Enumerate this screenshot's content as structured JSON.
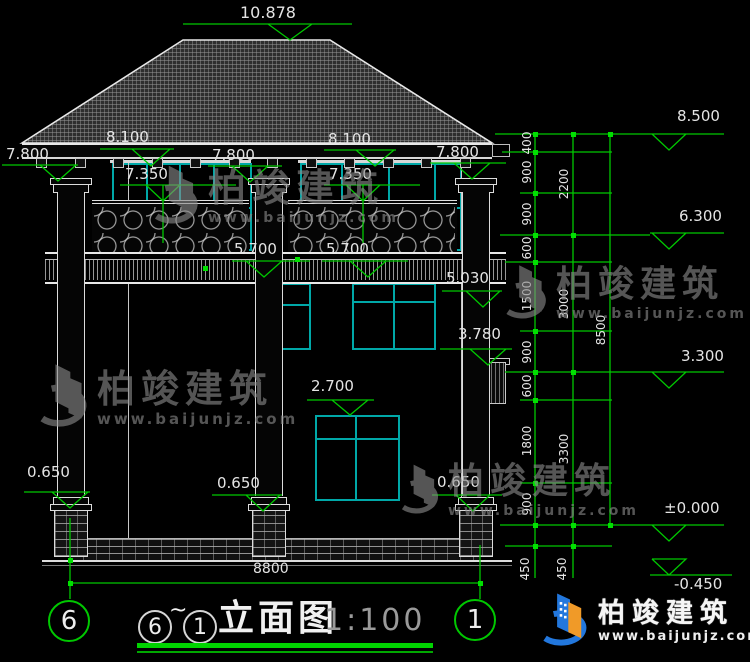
{
  "drawing": {
    "title": {
      "axis_start": "6",
      "tilde": "~",
      "axis_end": "1",
      "name": "立面图",
      "scale": "1:100"
    },
    "axis_bubbles": {
      "left": "6",
      "right": "1"
    },
    "overall_dim": "8800",
    "labels": [
      {
        "id": "ridge",
        "text": "10.878"
      },
      {
        "id": "l8100a",
        "text": "8.100"
      },
      {
        "id": "l8100b",
        "text": "8.100"
      },
      {
        "id": "l7800a",
        "text": "7.800"
      },
      {
        "id": "l7800b",
        "text": "7.800"
      },
      {
        "id": "l7800c",
        "text": "7.800"
      },
      {
        "id": "l7350a",
        "text": "7.350"
      },
      {
        "id": "l7350b",
        "text": "7.350"
      },
      {
        "id": "l5700a",
        "text": "5.700"
      },
      {
        "id": "l5700b",
        "text": "5.700"
      },
      {
        "id": "l5030",
        "text": "5.030"
      },
      {
        "id": "l3780",
        "text": "3.780"
      },
      {
        "id": "l2700",
        "text": "2.700"
      },
      {
        "id": "l0650a",
        "text": "0.650"
      },
      {
        "id": "l0650b",
        "text": "0.650"
      },
      {
        "id": "l0650c",
        "text": "0.650"
      },
      {
        "id": "r8500",
        "text": "8.500"
      },
      {
        "id": "r6300",
        "text": "6.300"
      },
      {
        "id": "r3300",
        "text": "3.300"
      },
      {
        "id": "r0000",
        "text": "±0.000"
      },
      {
        "id": "rn450",
        "text": "-0.450"
      },
      {
        "id": "d8800",
        "text": "8800"
      },
      {
        "id": "c400",
        "text": "400"
      },
      {
        "id": "c900a",
        "text": "900"
      },
      {
        "id": "c900b",
        "text": "900"
      },
      {
        "id": "c600a",
        "text": "600"
      },
      {
        "id": "c1500",
        "text": "1500"
      },
      {
        "id": "c900c",
        "text": "900"
      },
      {
        "id": "c600b",
        "text": "600"
      },
      {
        "id": "c1800",
        "text": "1800"
      },
      {
        "id": "c900d",
        "text": "900"
      },
      {
        "id": "c450a",
        "text": "450"
      },
      {
        "id": "c450b",
        "text": "450"
      },
      {
        "id": "c2200",
        "text": "2200"
      },
      {
        "id": "c3000",
        "text": "3000"
      },
      {
        "id": "c3300",
        "text": "3300"
      },
      {
        "id": "c8500",
        "text": "8500"
      }
    ]
  },
  "watermark": {
    "name": "柏竣建筑",
    "url": "www.baijunjz.com"
  },
  "logo": {
    "name": "柏竣建筑",
    "url": "www.baijunjz.com"
  },
  "colors": {
    "dimension_green": "#00c800",
    "window_teal": "#00a8a8",
    "line_white": "#e0e0e0",
    "logo_blue": "#2277dd",
    "logo_orange": "#f09a28"
  }
}
